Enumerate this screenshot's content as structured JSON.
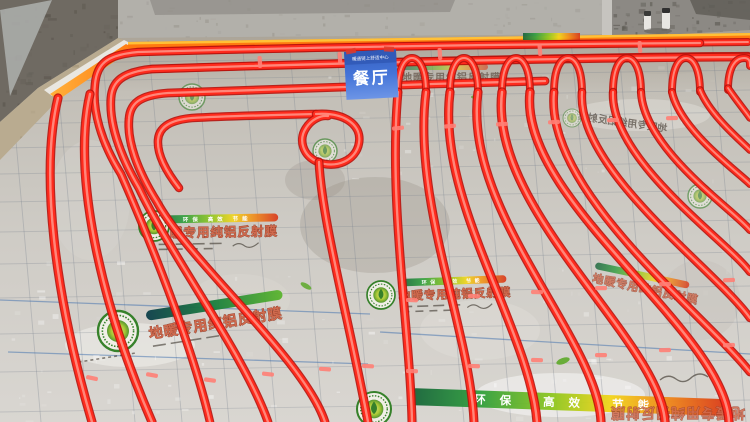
{
  "scene": {
    "type": "photo",
    "subject": "Underfloor heating installation: red PEX heating pipes laid in serpentine loops over silver foil insulation boards, bare concrete walls behind, orange edge strip along the wall"
  },
  "room_sign": {
    "header": "暖通链上舒适中心",
    "room_name": "餐厅"
  },
  "insulation_board": {
    "product_text": "地暖专用纯铝反射膜",
    "slogan": "环保 高效 节能",
    "logo": "green-leaf-eco-logo"
  },
  "colors": {
    "pipe": "#ff2b1d",
    "pipe_shadow": "#b8120c",
    "pipe_highlight": "#ff978a",
    "edge_strip": "#ff7a10",
    "sign_blue": "#3e6ed3",
    "foil": "#cdcac4",
    "wall_grey": "#b2b0aa"
  }
}
